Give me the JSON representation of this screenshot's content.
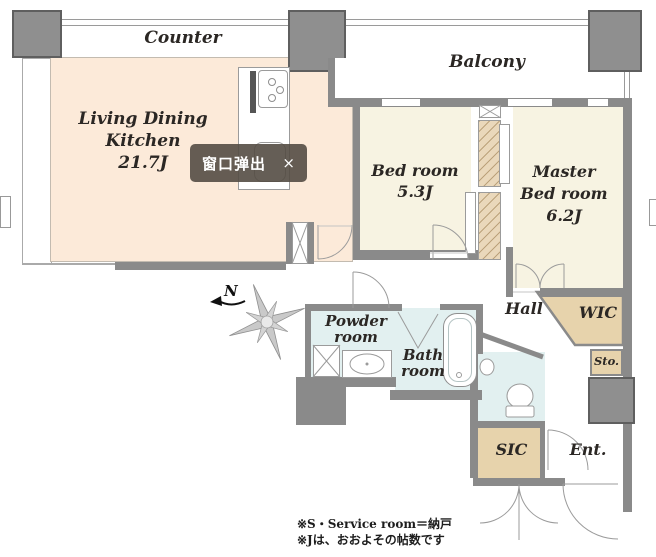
{
  "plan": {
    "counter_label": "Counter",
    "balcony_label": "Balcony",
    "compass": {
      "north": "N"
    },
    "rooms": {
      "ldk": {
        "name1": "Living Dining",
        "name2": "Kitchen",
        "size": "21.7J"
      },
      "bedroom": {
        "name": "Bed room",
        "size": "5.3J"
      },
      "master": {
        "name1": "Master",
        "name2": "Bed room",
        "size": "6.2J"
      },
      "hall": {
        "name": "Hall"
      },
      "wic": {
        "name": "WIC"
      },
      "sto": {
        "name": "Sto."
      },
      "powder": {
        "name1": "Powder",
        "name2": "room"
      },
      "bath": {
        "name1": "Bath",
        "name2": "room"
      },
      "sic": {
        "name": "SIC"
      },
      "ent": {
        "name": "Ent."
      }
    },
    "footnotes": [
      "※S・Service room＝納戸",
      "※Jは、おおよその帖数です"
    ]
  },
  "popup": {
    "label": "窗口弹出",
    "close": "×"
  },
  "colors": {
    "ldk": "#fcead9",
    "bedroom": "#f7f3e2",
    "wet": "#e2f0f0",
    "closet": "#e7d3ac",
    "wall": "#8a8a8a",
    "pillar": "#8f8f8f",
    "popup_bg": "#554c44",
    "label_text": "#2b2724"
  }
}
